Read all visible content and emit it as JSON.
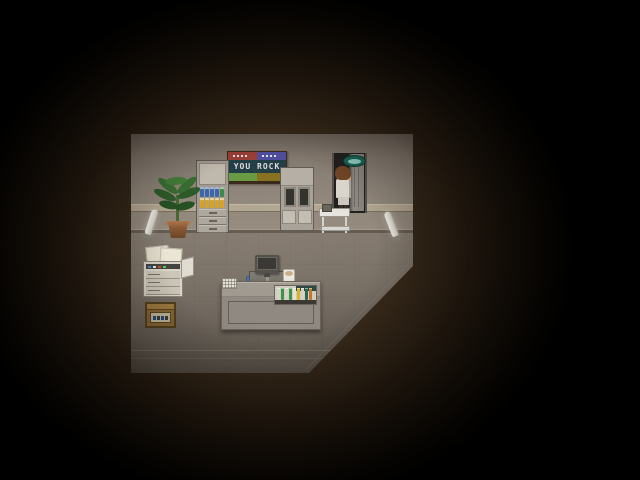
{
  "viewport": {
    "width": 640,
    "height": 480
  },
  "banner": {
    "text": "YOU ROCK",
    "colors": {
      "frame": "#3b2b1b",
      "top_left": "#9c4038",
      "top_right": "#5050a0",
      "middle_bg": "#234049",
      "text": "#e8dde0",
      "bottom_left": "#6c9c44",
      "bottom_right": "#8a7420"
    }
  },
  "room": {
    "wall_color": "#948a7e",
    "trim_color": "#b4a993",
    "floor_color": "#7d7469",
    "darkness_color": "#000000",
    "glow_color": "#3a2c1c"
  },
  "shelf": {
    "bottle_rows": [
      {
        "colors": [
          "#3a68b0",
          "#3a68b0",
          "#3a68b0",
          "#3a68b0",
          "#3f8a4a"
        ]
      },
      {
        "colors": [
          "#d8a52a",
          "#d8a52a",
          "#d8a52a",
          "#d8a52a",
          "#d8a52a"
        ]
      }
    ],
    "drawer_count": 3
  },
  "tube_rack": {
    "tube_colors": [
      "#d8d4c8",
      "#3a9848",
      "#d8d4c8",
      "#3a9848",
      "#e8e4d8",
      "#d8b828",
      "#d8d4c8",
      "#2a6a5a",
      "#c87828"
    ]
  },
  "copier": {
    "button_colors": [
      "#4a8ad8",
      "#e8e8e8",
      "#d84a3a",
      "#4ad85a"
    ]
  },
  "door_sign": {
    "body_color": "#1a6455",
    "center_color": "#8fd0c4"
  },
  "character": {
    "role": "scientist",
    "coat_color": "#ddd8d0",
    "hair_color": "#714626"
  },
  "objects": [
    "you-rock-banner",
    "supply-shelf",
    "potted-plant",
    "display-cabinet",
    "doorway",
    "door-sign",
    "scientist-character",
    "medical-cart",
    "wall-lamp-left",
    "wall-lamp-right",
    "copier-machine",
    "wooden-crate",
    "computer-monitor",
    "computer-desk",
    "blue-chair",
    "mug",
    "counter",
    "keypad",
    "test-tube-rack"
  ]
}
